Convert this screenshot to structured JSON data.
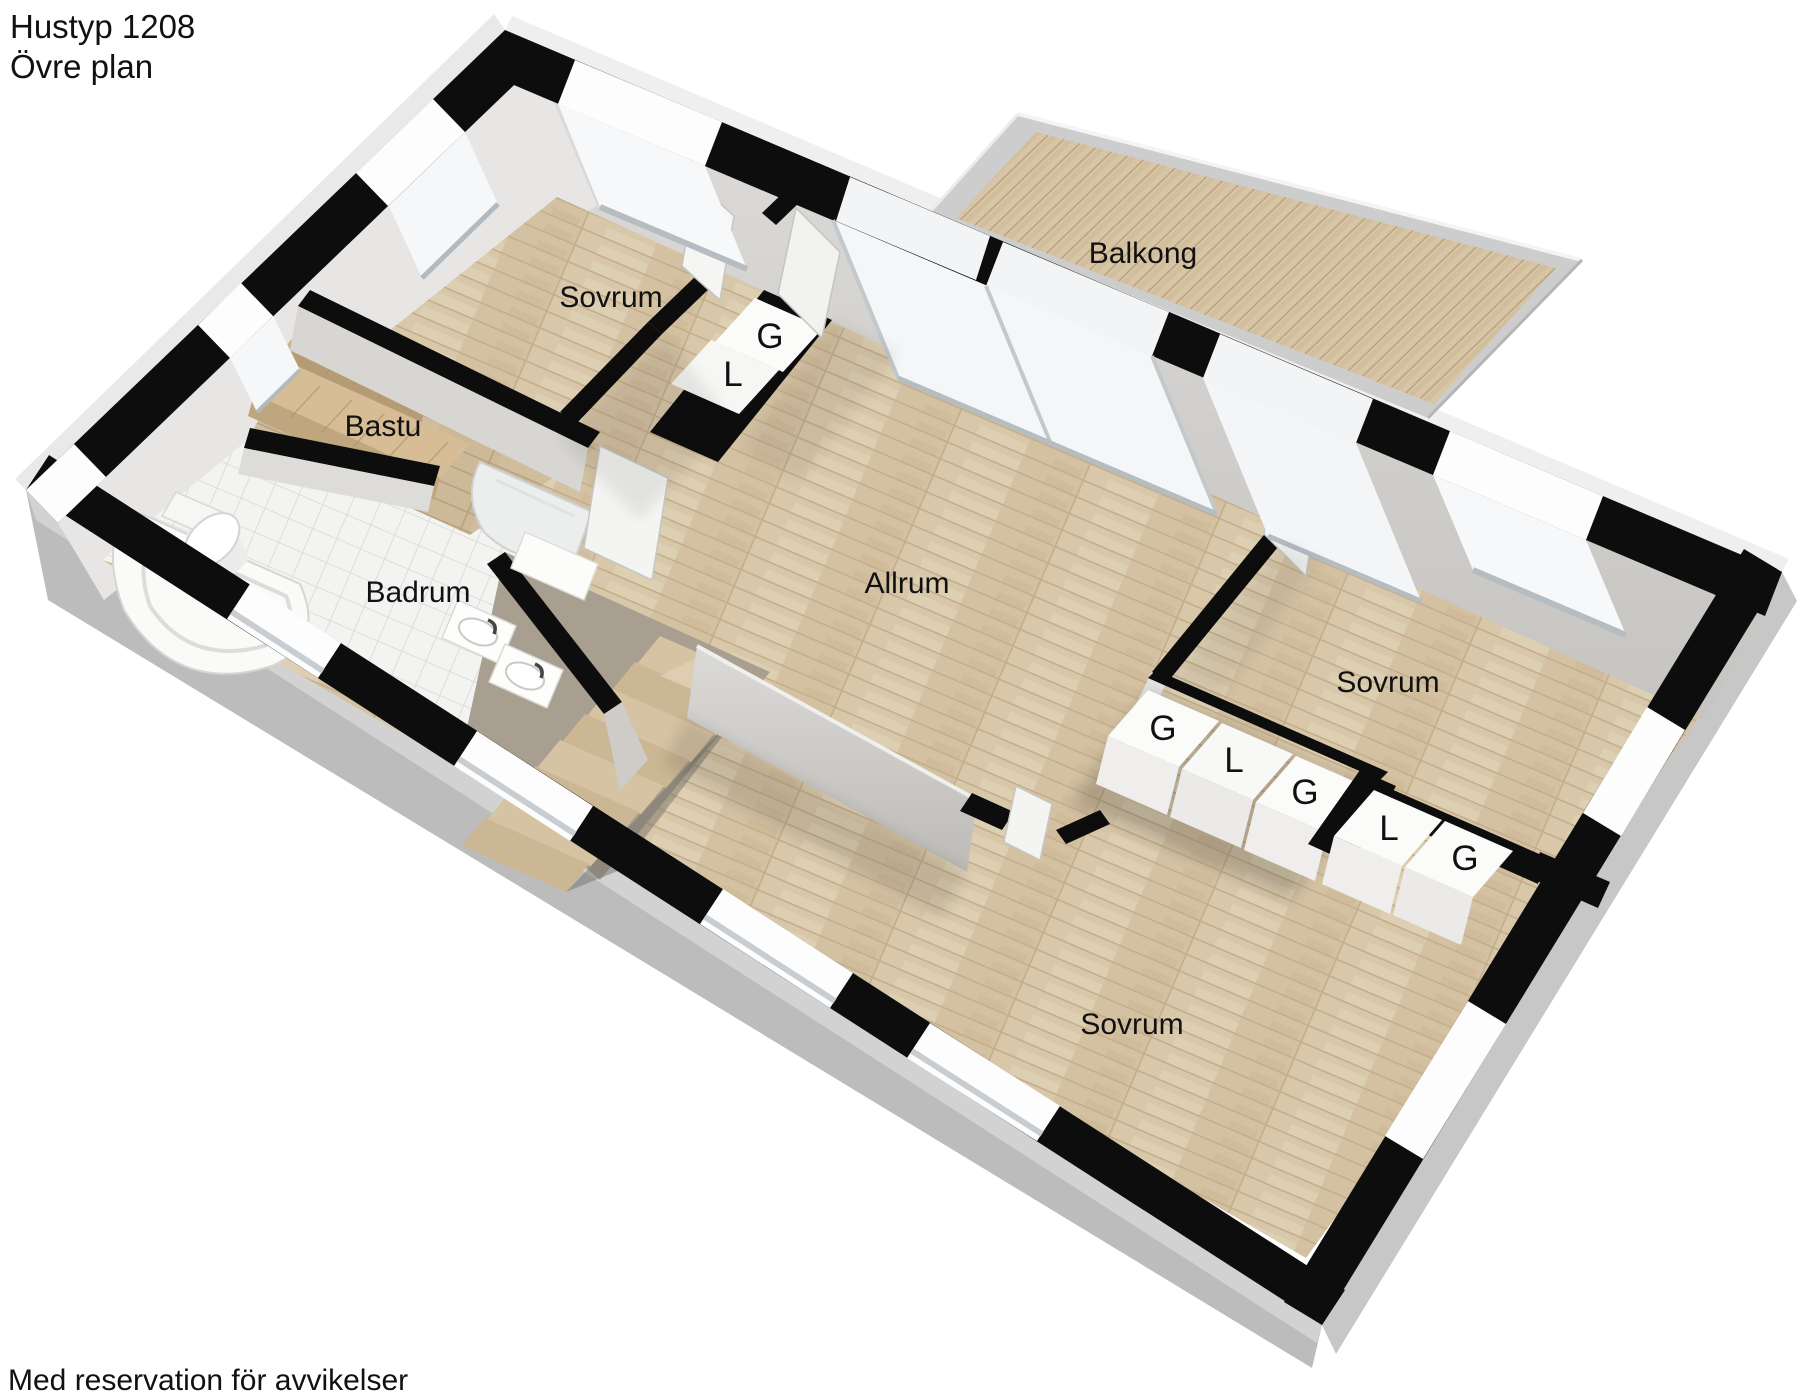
{
  "page": {
    "title_line1": "Hustyp 1208",
    "title_line2": "Övre plan",
    "footer_note": "Med reservation för avvikelser"
  },
  "floorplan": {
    "rooms": [
      {
        "id": "bedroom-top",
        "label": "Sovrum"
      },
      {
        "id": "sauna",
        "label": "Bastu"
      },
      {
        "id": "bathroom",
        "label": "Badrum"
      },
      {
        "id": "living-room",
        "label": "Allrum"
      },
      {
        "id": "balcony",
        "label": "Balkong"
      },
      {
        "id": "bedroom-right",
        "label": "Sovrum"
      },
      {
        "id": "bedroom-bottom",
        "label": "Sovrum"
      }
    ],
    "wardrobes": {
      "bedroom_top": [
        "G",
        "L"
      ],
      "hall_row": [
        "G",
        "L",
        "G"
      ],
      "bedroom_bottom": [
        "L",
        "G"
      ]
    },
    "colors": {
      "wall_top": "#0d0d0d",
      "wood_floor": "#d8c7a9",
      "deck_wood": "#d5c3a2",
      "tile_floor": "#f3f3f2",
      "exterior_face": "#bcbcbc",
      "interior_face": "#d6d4d2",
      "text": "#111111"
    }
  }
}
